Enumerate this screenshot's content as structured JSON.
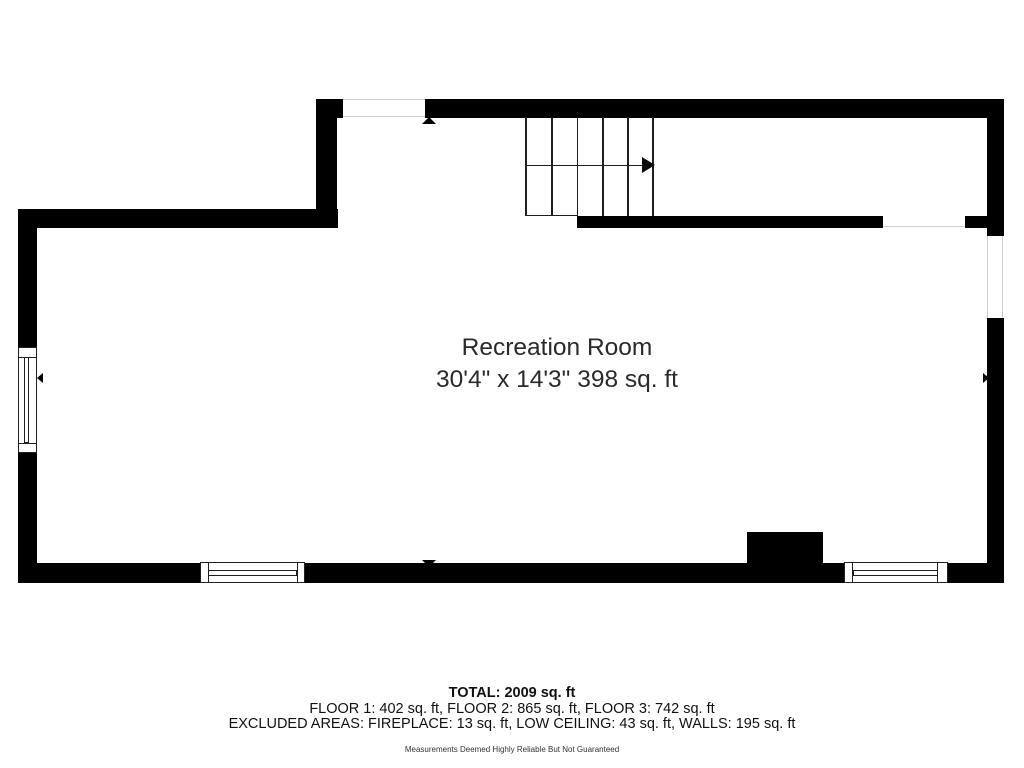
{
  "room": {
    "name": "Recreation Room",
    "dimensions": "30'4\" x 14'3\" 398 sq. ft"
  },
  "summary": {
    "total": "TOTAL: 2009 sq. ft",
    "floors": "FLOOR 1: 402 sq. ft, FLOOR 2: 865 sq. ft, FLOOR 3: 742 sq. ft",
    "excluded": "EXCLUDED AREAS: FIREPLACE: 13 sq. ft, LOW CEILING: 43 sq. ft, WALLS: 195 sq. ft",
    "disclaimer": "Measurements Deemed Highly Reliable But Not Guaranteed"
  },
  "icons": {
    "stair_arrow": "right-arrow",
    "entry_marker_top": "up-triangle",
    "entry_marker_bottom": "down-triangle",
    "marker_left_wall": "left-triangle",
    "marker_right_wall": "right-triangle"
  },
  "colors": {
    "wall": "#000000",
    "background": "#ffffff",
    "stair_line": "#1f1f1f",
    "opening_line": "#cfcfcf",
    "text": "#1d1d1f"
  }
}
